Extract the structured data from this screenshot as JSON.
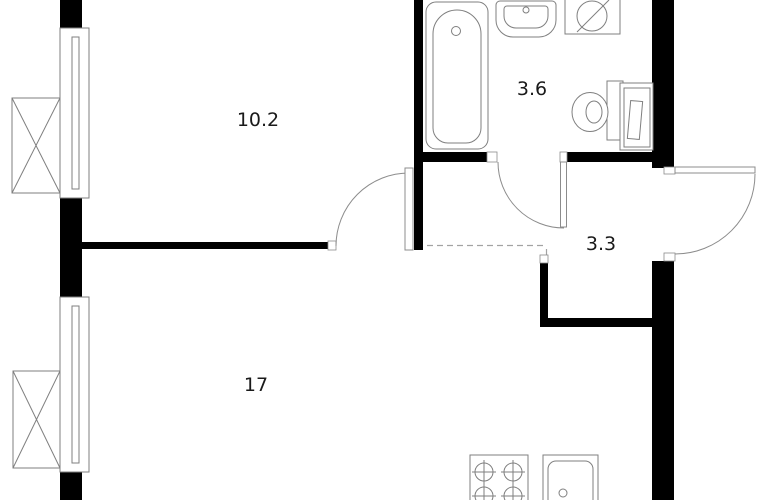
{
  "plan": {
    "title": "apartment-floor-plan",
    "rooms": [
      {
        "name": "room",
        "area": "10.2"
      },
      {
        "name": "bathroom",
        "area": "3.6"
      },
      {
        "name": "hallway",
        "area": "3.3"
      },
      {
        "name": "living-kitchen",
        "area": "17"
      }
    ],
    "fixtures": [
      "bathtub",
      "bathroom-sink",
      "washing-machine",
      "toilet",
      "water-heater-cabinet",
      "stove-4-burner",
      "kitchen-sink",
      "window",
      "window",
      "ac-unit",
      "ac-unit",
      "interior-door",
      "bathroom-door",
      "entry-door"
    ],
    "colors": {
      "wall": "#000000",
      "fixture_line": "#7f7f7f",
      "door_line": "#8c8c8c",
      "dashed_opening": "#a3a3a3",
      "background": "#ffffff",
      "label_text": "#1a1a1a"
    }
  }
}
